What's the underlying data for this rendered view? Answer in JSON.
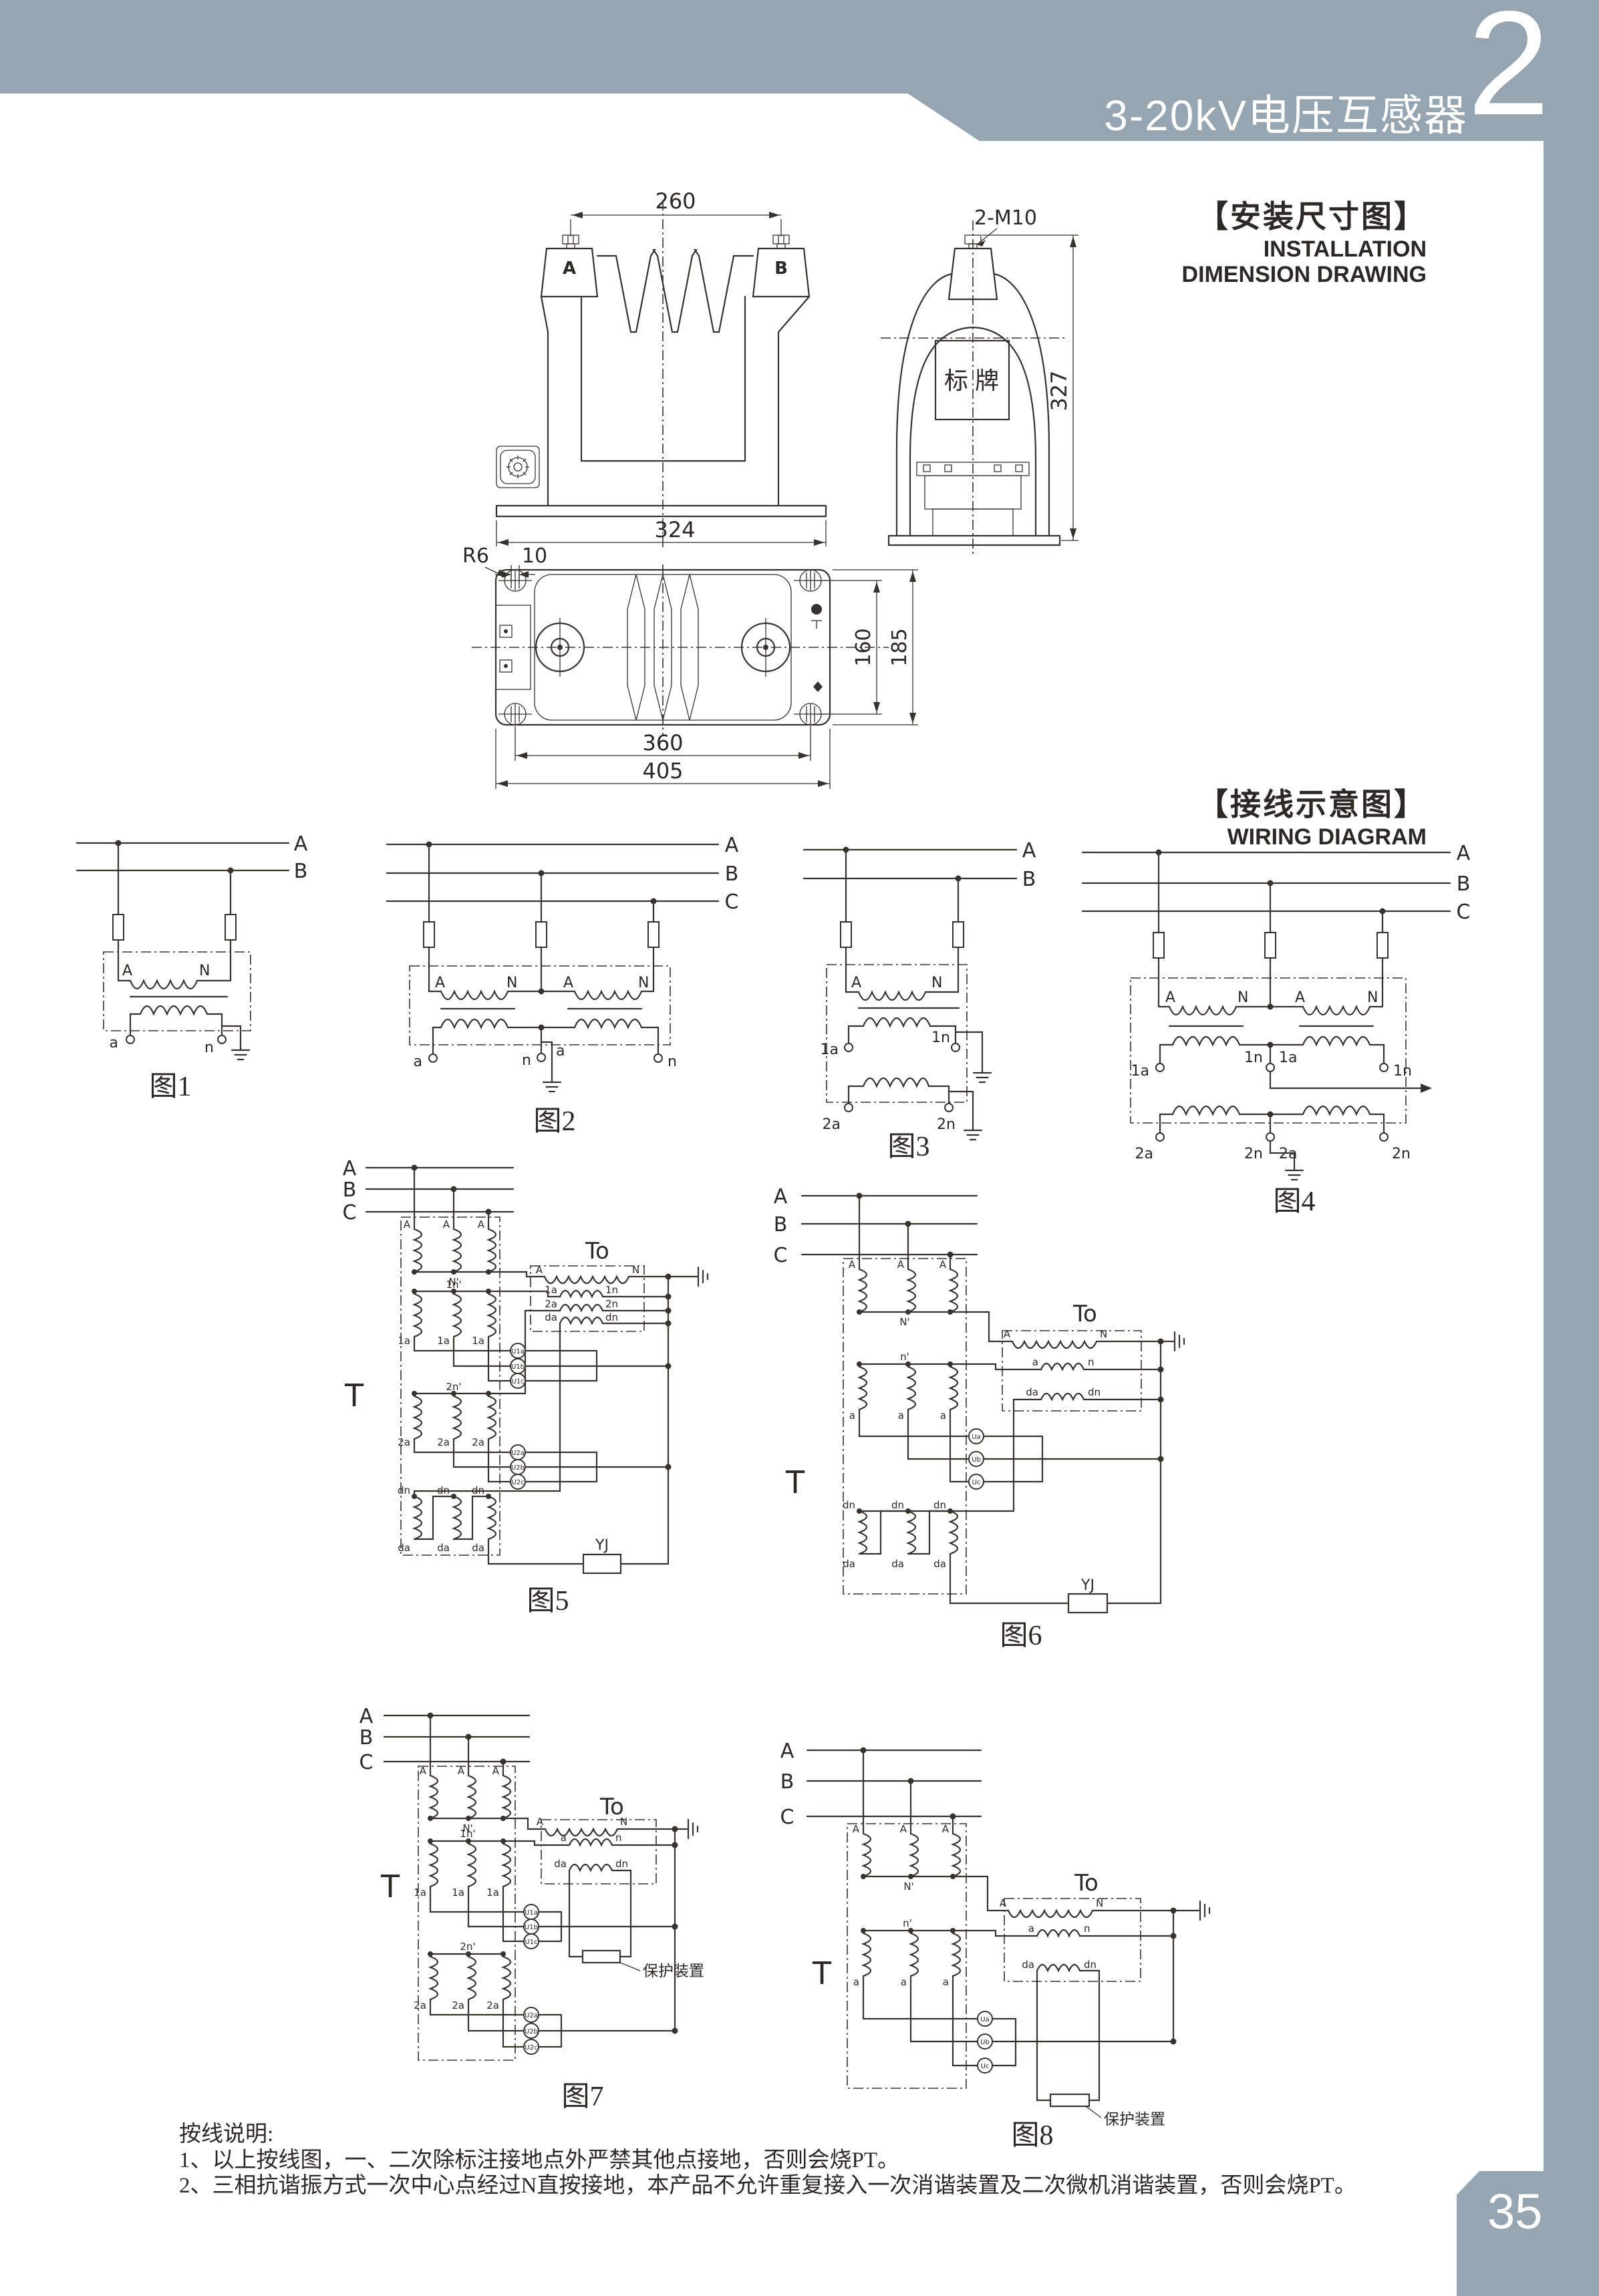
{
  "header": {
    "title": "3-20kV电压互感器",
    "chapter": "2"
  },
  "headings": {
    "install_zh": "【安装尺寸图】",
    "install_en1": "INSTALLATION",
    "install_en2": "DIMENSION DRAWING",
    "wiring_zh": "【接线示意图】",
    "wiring_en": "WIRING DIAGRAM"
  },
  "install": {
    "front": {
      "dim_top": "260",
      "dim_bottom": "324",
      "term_a": "A",
      "term_b": "B"
    },
    "side": {
      "bolt": "2-M10",
      "plate": "标牌",
      "dim_h": "327"
    },
    "plan": {
      "r": "R6",
      "slot": "10",
      "d160": "160",
      "d185": "185",
      "d360": "360",
      "d405": "405"
    }
  },
  "figs": {
    "f1": {
      "cap": "图1",
      "busA": "A",
      "busB": "B",
      "pA": "A",
      "pN": "N",
      "sa": "a",
      "sn": "n"
    },
    "f2": {
      "cap": "图2",
      "busA": "A",
      "busB": "B",
      "busC": "C",
      "pA": "A",
      "pN": "N",
      "sa": "a",
      "sn": "n"
    },
    "f3": {
      "cap": "图3",
      "busA": "A",
      "busB": "B",
      "pA": "A",
      "pN": "N",
      "s1a": "1a",
      "s1n": "1n",
      "s2a": "2a",
      "s2n": "2n"
    },
    "f4": {
      "cap": "图4",
      "busA": "A",
      "busB": "B",
      "busC": "C",
      "pA": "A",
      "pN": "N",
      "s1a": "1a",
      "s1n": "1n",
      "s2a": "2a",
      "s2n": "2n"
    },
    "f5": {
      "cap": "图5",
      "busA": "A",
      "busB": "B",
      "busC": "C",
      "t": "T",
      "to": "To",
      "colA": "A",
      "nP": "N'",
      "r2": "1n'",
      "r2b": "1a",
      "r3": "2n'",
      "r3b": "2a",
      "dn": "dn",
      "da": "da",
      "m1a": "U1a",
      "m1b": "U1b",
      "m1c": "U1c",
      "m2a": "U2a",
      "m2b": "U2b",
      "m2c": "U2c",
      "wA": "A",
      "wN": "N",
      "w1a": "1a",
      "w1n": "1n",
      "w2a": "2a",
      "w2n": "2n",
      "wda": "da",
      "wdn": "dn",
      "yj": "YJ"
    },
    "f6": {
      "cap": "图6",
      "busA": "A",
      "busB": "B",
      "busC": "C",
      "t": "T",
      "to": "To",
      "colA": "A",
      "nP": "N'",
      "r2": "n'",
      "r2b": "a",
      "dn": "dn",
      "da": "da",
      "ma": "Ua",
      "mb": "Ub",
      "mc": "Uc",
      "wA": "A",
      "wN": "N",
      "wa": "a",
      "wn": "n",
      "wda": "da",
      "wdn": "dn",
      "yj": "YJ"
    },
    "f7": {
      "cap": "图7",
      "busA": "A",
      "busB": "B",
      "busC": "C",
      "t": "T",
      "to": "To",
      "colA": "A",
      "nP": "N'",
      "r2": "1n'",
      "r2b": "1a",
      "r3": "2n'",
      "r3b": "2a",
      "m1a": "U1a",
      "m1b": "U1b",
      "m1c": "U1c",
      "m2a": "U2a",
      "m2b": "U2b",
      "m2c": "U2c",
      "wA": "A",
      "wN": "N",
      "wa": "a",
      "wn": "n",
      "wda": "da",
      "wdn": "dn",
      "prot": "保护装置"
    },
    "f8": {
      "cap": "图8",
      "busA": "A",
      "busB": "B",
      "busC": "C",
      "t": "T",
      "to": "To",
      "colA": "A",
      "nP": "N'",
      "r2": "n'",
      "r2b": "a",
      "ma": "Ua",
      "mb": "Ub",
      "mc": "Uc",
      "wA": "A",
      "wN": "N",
      "wa": "a",
      "wn": "n",
      "wda": "da",
      "wdn": "dn",
      "prot": "保护装置"
    }
  },
  "notes": {
    "title": "按线说明:",
    "l1": "1、以上按线图，一、二次除标注接地点外严禁其他点接地，否则会烧PT。",
    "l2": "2、三相抗谐振方式一次中心点经过N直按接地，本产品不允许重复接入一次消谐装置及二次微机消谐装置，否则会烧PT。"
  },
  "page_number": "35"
}
